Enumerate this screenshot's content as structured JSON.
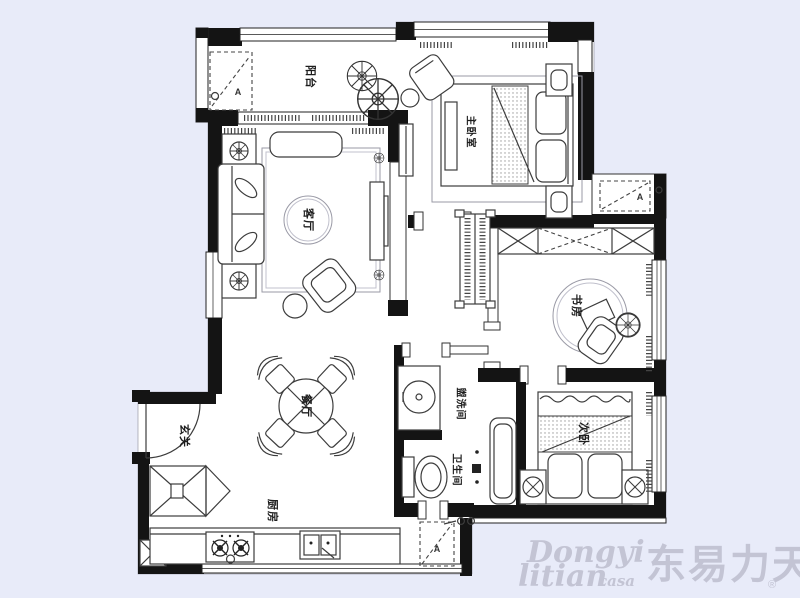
{
  "plan": {
    "rooms": {
      "balcony": "阳台",
      "master_bedroom": "主卧室",
      "living_room": "客厅",
      "study": "书房",
      "dining_room": "餐厅",
      "entry": "玄关",
      "kitchen": "厨房",
      "washroom": "盥洗间",
      "bathroom": "卫生间",
      "second_bedroom": "次卧"
    },
    "ac_unit_label": "A"
  },
  "watermark": {
    "en_line1": "Dongyi",
    "en_line2": "litian",
    "en_suffix": "casa",
    "cn": "东易力天",
    "registered": "®"
  },
  "colors": {
    "page_background": "#e8ebf9",
    "plan_background": "#ffffff",
    "wall": "#141414",
    "furniture_line": "#3c3c3c",
    "soft_line": "#9a9aa6",
    "watermark": "#c3c4d4"
  }
}
